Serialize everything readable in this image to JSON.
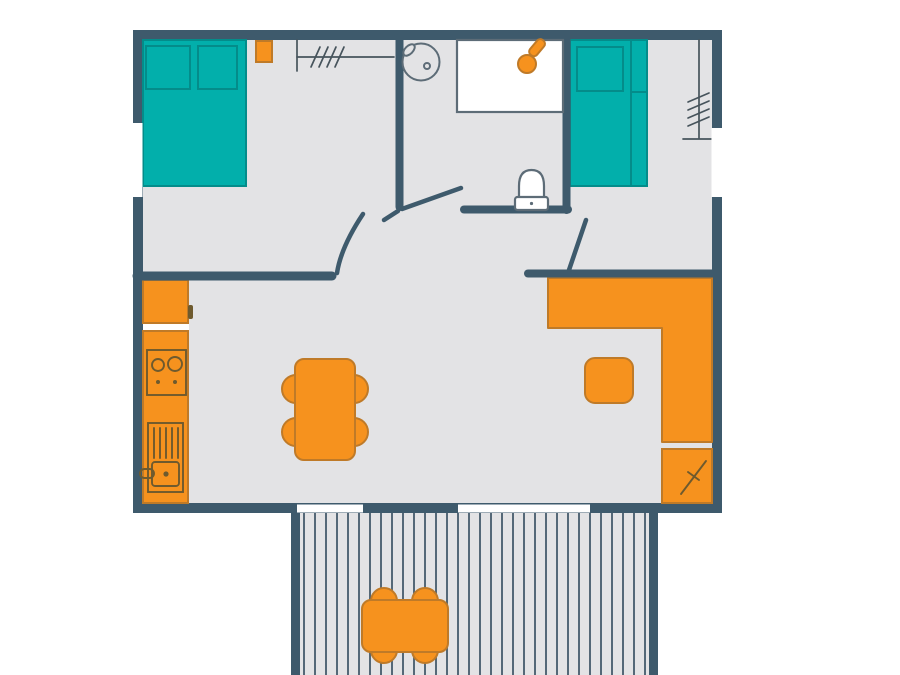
{
  "palette": {
    "background": "#ffffff",
    "wall": "#3e5a6c",
    "floor": "#e3e3e5",
    "window": "#ffffff",
    "teal": "#02afab",
    "teal_dark": "#048c8a",
    "orange": "#f6921e",
    "orange_dark": "#bf7a28",
    "fixture_outline": "#5d6c77",
    "appliance_outline": "#6e5a2e",
    "wardrobe_line": "#47545c",
    "deck_line": "#455a6b"
  },
  "plan": {
    "rooms": [
      "bedroom-1",
      "bedroom-2",
      "bathroom",
      "living-kitchen-area",
      "terrace"
    ],
    "furniture": [
      "double-bed",
      "nightstand",
      "wardrobe-rail-1",
      "single-bed",
      "wardrobe-rail-2",
      "washbasin",
      "shower",
      "toilet",
      "fridge",
      "stove",
      "kitchen-sink",
      "dining-table-with-chairs",
      "stool",
      "l-shaped-counter",
      "storage-cabinet",
      "patio-table-with-chairs"
    ],
    "deck": {
      "board_start_x": 304,
      "board_end_x": 646,
      "board_spacing": 11,
      "top_y": 513,
      "bottom_y": 675
    }
  }
}
